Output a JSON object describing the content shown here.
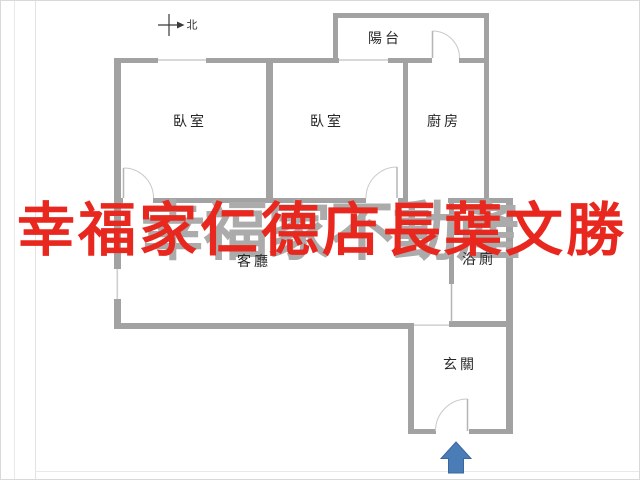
{
  "floorplan": {
    "rooms": [
      {
        "id": "bedroom-1",
        "label": "臥室"
      },
      {
        "id": "bedroom-2",
        "label": "臥室"
      },
      {
        "id": "kitchen",
        "label": "廚房"
      },
      {
        "id": "balcony",
        "label": "陽台"
      },
      {
        "id": "living-room",
        "label": "客廳"
      },
      {
        "id": "bathroom",
        "label": "浴廁"
      },
      {
        "id": "foyer",
        "label": "玄關"
      }
    ],
    "compass": {
      "label": "北",
      "icon": "north-arrow-icon"
    },
    "entrance_arrow": {
      "icon": "entrance-arrow-icon",
      "color": "#4a7cb8"
    },
    "colors": {
      "wall": "#a2a2a2",
      "window_line": "#cfcfcf",
      "door_arc": "#c9c9c9",
      "door_leaf": "#b5b5b5",
      "label_text": "#262626"
    }
  },
  "watermarks": {
    "red": {
      "text": "幸福家仁德店長葉文勝",
      "color": "#e8281e"
    },
    "gray": {
      "text": "幸福家不動產",
      "color": "#ababab"
    }
  }
}
